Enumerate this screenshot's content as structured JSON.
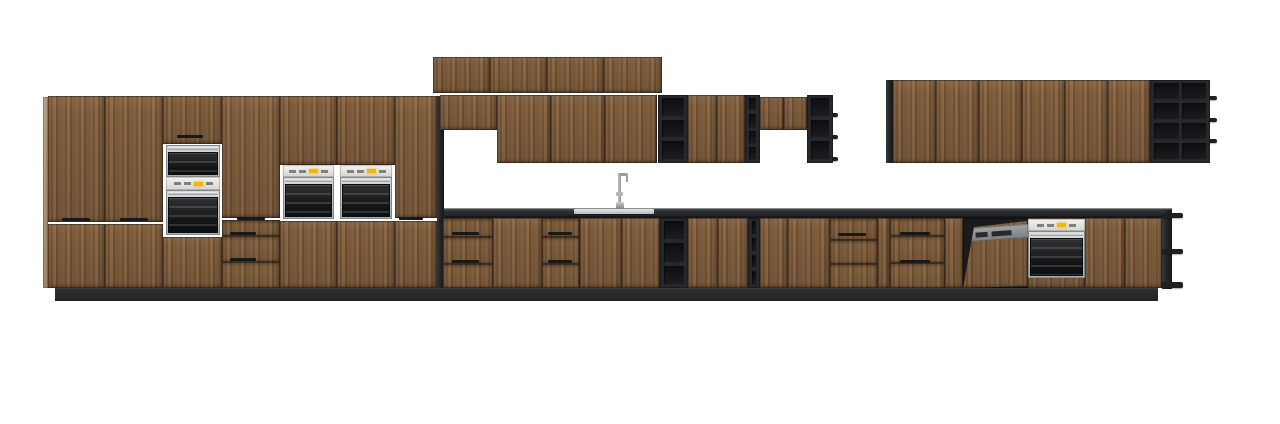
{
  "meta": {
    "canvas_w": 1280,
    "canvas_h": 424,
    "background": "#ffffff"
  },
  "palette": {
    "wood": "#7c5a3c",
    "wood_dark": "#6d4e33",
    "wood_light": "#8a6845",
    "frame_dark": "#26282b",
    "cubby_dark": "#101113",
    "counter": "#2c2f31",
    "plinth": "#26282a",
    "steel_light": "#dadddf",
    "steel": "#a9adb0",
    "panel_light": "#f3f2ef",
    "led_yellow": "#f2b705",
    "dishwasher_gray": "#8d9194",
    "oven_black": "#131416"
  },
  "scene": {
    "description_units": "kitchen-elevation-render",
    "units": [
      {
        "n": "plinth",
        "t": "plinth",
        "x": 55,
        "y": 288,
        "w": 1103,
        "h": 13
      },
      {
        "n": "countertop",
        "t": "counter",
        "x": 441,
        "y": 208,
        "w": 731,
        "h": 10
      },
      {
        "n": "sink-basin",
        "t": "sink",
        "x": 574,
        "y": 209,
        "w": 80,
        "h": 5
      },
      {
        "n": "tall-end-panel-left",
        "t": "door-lite",
        "x": 43,
        "y": 97,
        "w": 5,
        "h": 191
      },
      {
        "n": "tall-door-upper",
        "t": "door",
        "x": 48,
        "y": 96,
        "w": 57,
        "h": 126
      },
      {
        "n": "tall-door-lower",
        "t": "door",
        "x": 48,
        "y": 224,
        "w": 57,
        "h": 64
      },
      {
        "n": "door-handle",
        "t": "handle",
        "x": 62,
        "y": 218,
        "w": 28,
        "h": 3
      },
      {
        "n": "tall-door-upper",
        "t": "door",
        "x": 105,
        "y": 96,
        "w": 58,
        "h": 126
      },
      {
        "n": "tall-door-lower",
        "t": "door",
        "x": 105,
        "y": 224,
        "w": 58,
        "h": 64
      },
      {
        "n": "door-handle",
        "t": "handle",
        "x": 120,
        "y": 218,
        "w": 28,
        "h": 3
      },
      {
        "n": "appliance-tower-top-door",
        "t": "door",
        "x": 163,
        "y": 96,
        "w": 59,
        "h": 48
      },
      {
        "n": "door-handle",
        "t": "handle",
        "x": 177,
        "y": 135,
        "w": 26,
        "h": 3
      },
      {
        "n": "compact-oven",
        "t": "oven",
        "x": 166,
        "y": 145,
        "w": 54,
        "h": 32
      },
      {
        "n": "oven-control-panel",
        "t": "cpanel",
        "x": 166,
        "y": 177,
        "w": 54,
        "h": 13
      },
      {
        "n": "built-in-oven",
        "t": "oven",
        "x": 166,
        "y": 190,
        "w": 54,
        "h": 45
      },
      {
        "n": "appliance-tower-bottom-door",
        "t": "door",
        "x": 163,
        "y": 237,
        "w": 59,
        "h": 51
      },
      {
        "n": "tall-door-upper",
        "t": "door",
        "x": 222,
        "y": 96,
        "w": 58,
        "h": 122
      },
      {
        "n": "door-handle",
        "t": "handle",
        "x": 237,
        "y": 217,
        "w": 28,
        "h": 3
      },
      {
        "n": "tall-drawer",
        "t": "drawer",
        "x": 222,
        "y": 220,
        "w": 58,
        "h": 16
      },
      {
        "n": "tall-drawer",
        "t": "drawer",
        "x": 222,
        "y": 236,
        "w": 58,
        "h": 26
      },
      {
        "n": "drawer-handle",
        "t": "handle",
        "x": 230,
        "y": 232,
        "w": 26,
        "h": 3
      },
      {
        "n": "tall-drawer",
        "t": "drawer",
        "x": 222,
        "y": 262,
        "w": 58,
        "h": 26
      },
      {
        "n": "drawer-handle",
        "t": "handle",
        "x": 230,
        "y": 258,
        "w": 26,
        "h": 3
      },
      {
        "n": "appliance-tower-top-door",
        "t": "door",
        "x": 280,
        "y": 96,
        "w": 57,
        "h": 69
      },
      {
        "n": "oven-control-panel",
        "t": "cpanel",
        "x": 283,
        "y": 165,
        "w": 51,
        "h": 12
      },
      {
        "n": "built-in-oven",
        "t": "oven",
        "x": 283,
        "y": 177,
        "w": 51,
        "h": 42
      },
      {
        "n": "appliance-tower-bottom-door",
        "t": "door",
        "x": 280,
        "y": 221,
        "w": 57,
        "h": 67
      },
      {
        "n": "appliance-tower-top-door",
        "t": "door",
        "x": 337,
        "y": 96,
        "w": 58,
        "h": 69
      },
      {
        "n": "oven-control-panel",
        "t": "cpanel",
        "x": 340,
        "y": 165,
        "w": 52,
        "h": 12
      },
      {
        "n": "built-in-oven",
        "t": "oven",
        "x": 340,
        "y": 177,
        "w": 52,
        "h": 42
      },
      {
        "n": "appliance-tower-bottom-door",
        "t": "door",
        "x": 337,
        "y": 221,
        "w": 58,
        "h": 67
      },
      {
        "n": "tall-door-upper",
        "t": "door",
        "x": 395,
        "y": 96,
        "w": 42,
        "h": 122
      },
      {
        "n": "door-handle",
        "t": "handle",
        "x": 399,
        "y": 217,
        "w": 24,
        "h": 3
      },
      {
        "n": "tall-door-lower",
        "t": "door",
        "x": 395,
        "y": 221,
        "w": 42,
        "h": 67
      },
      {
        "n": "tall-run-side-panel",
        "t": "panel-dark",
        "x": 437,
        "y": 96,
        "w": 7,
        "h": 192
      },
      {
        "n": "wall-top-door",
        "t": "door",
        "x": 433,
        "y": 57,
        "w": 57,
        "h": 36
      },
      {
        "n": "wall-top-door",
        "t": "door",
        "x": 490,
        "y": 57,
        "w": 57,
        "h": 36
      },
      {
        "n": "wall-top-door",
        "t": "door",
        "x": 547,
        "y": 57,
        "w": 57,
        "h": 36
      },
      {
        "n": "wall-top-door",
        "t": "door",
        "x": 604,
        "y": 57,
        "w": 58,
        "h": 36
      },
      {
        "n": "wall-cabinet-short",
        "t": "door",
        "x": 440,
        "y": 95,
        "w": 57,
        "h": 35
      },
      {
        "n": "wall-door",
        "t": "door",
        "x": 497,
        "y": 95,
        "w": 54,
        "h": 68
      },
      {
        "n": "wall-door",
        "t": "door",
        "x": 551,
        "y": 95,
        "w": 54,
        "h": 68
      },
      {
        "n": "wall-door",
        "t": "door",
        "x": 605,
        "y": 95,
        "w": 52,
        "h": 68
      },
      {
        "n": "wall-open-shelf",
        "t": "shelf",
        "x": 658,
        "y": 95,
        "w": 30,
        "h": 68,
        "r": 3
      },
      {
        "n": "wall-door",
        "t": "door",
        "x": 688,
        "y": 95,
        "w": 29,
        "h": 68
      },
      {
        "n": "wall-door",
        "t": "door",
        "x": 717,
        "y": 95,
        "w": 28,
        "h": 68
      },
      {
        "n": "wall-wine-shelf",
        "t": "shelf",
        "x": 745,
        "y": 95,
        "w": 15,
        "h": 68,
        "r": 4
      },
      {
        "n": "wall-short-door",
        "t": "door",
        "x": 760,
        "y": 97,
        "w": 24,
        "h": 33
      },
      {
        "n": "wall-short-door",
        "t": "door",
        "x": 784,
        "y": 97,
        "w": 23,
        "h": 33
      },
      {
        "n": "wall-open-shelf",
        "t": "shelf",
        "x": 807,
        "y": 95,
        "w": 26,
        "h": 68,
        "r": 3
      },
      {
        "n": "shelf-fin",
        "t": "fin",
        "x": 833,
        "y": 113,
        "w": 5,
        "h": 4
      },
      {
        "n": "shelf-fin",
        "t": "fin",
        "x": 833,
        "y": 135,
        "w": 5,
        "h": 4
      },
      {
        "n": "shelf-fin",
        "t": "fin",
        "x": 833,
        "y": 157,
        "w": 5,
        "h": 4
      },
      {
        "n": "wall-run-edge-panel",
        "t": "panel-dark",
        "x": 886,
        "y": 80,
        "w": 7,
        "h": 83
      },
      {
        "n": "wall-door",
        "t": "door",
        "x": 893,
        "y": 80,
        "w": 43,
        "h": 83
      },
      {
        "n": "wall-door",
        "t": "door",
        "x": 936,
        "y": 80,
        "w": 43,
        "h": 83
      },
      {
        "n": "wall-door",
        "t": "door",
        "x": 979,
        "y": 80,
        "w": 43,
        "h": 83
      },
      {
        "n": "wall-door",
        "t": "door",
        "x": 1022,
        "y": 80,
        "w": 43,
        "h": 83
      },
      {
        "n": "wall-door",
        "t": "door",
        "x": 1065,
        "y": 80,
        "w": 43,
        "h": 83
      },
      {
        "n": "wall-door",
        "t": "door",
        "x": 1108,
        "y": 80,
        "w": 42,
        "h": 83
      },
      {
        "n": "wall-open-shelf-grid",
        "t": "grid",
        "x": 1150,
        "y": 80,
        "w": 60,
        "h": 83,
        "r": 4,
        "c": 2
      },
      {
        "n": "shelf-fin",
        "t": "fin",
        "x": 1210,
        "y": 96,
        "w": 7,
        "h": 4
      },
      {
        "n": "shelf-fin",
        "t": "fin",
        "x": 1210,
        "y": 118,
        "w": 7,
        "h": 4
      },
      {
        "n": "shelf-fin",
        "t": "fin",
        "x": 1210,
        "y": 139,
        "w": 7,
        "h": 4
      },
      {
        "n": "faucet",
        "t": "faucet",
        "x": 612,
        "y": 172,
        "w": 17,
        "h": 37
      },
      {
        "n": "base-drawer",
        "t": "drawer",
        "x": 443,
        "y": 218,
        "w": 50,
        "h": 19
      },
      {
        "n": "base-drawer",
        "t": "drawer",
        "x": 443,
        "y": 237,
        "w": 50,
        "h": 27
      },
      {
        "n": "drawer-handle",
        "t": "handle",
        "x": 452,
        "y": 232,
        "w": 27,
        "h": 3
      },
      {
        "n": "base-drawer",
        "t": "drawer",
        "x": 443,
        "y": 264,
        "w": 50,
        "h": 24
      },
      {
        "n": "drawer-handle",
        "t": "handle",
        "x": 452,
        "y": 260,
        "w": 27,
        "h": 3
      },
      {
        "n": "base-door",
        "t": "door",
        "x": 493,
        "y": 218,
        "w": 49,
        "h": 70
      },
      {
        "n": "base-drawer",
        "t": "drawer",
        "x": 542,
        "y": 218,
        "w": 38,
        "h": 19
      },
      {
        "n": "base-drawer",
        "t": "drawer",
        "x": 542,
        "y": 237,
        "w": 38,
        "h": 27
      },
      {
        "n": "drawer-handle",
        "t": "handle",
        "x": 548,
        "y": 232,
        "w": 24,
        "h": 3
      },
      {
        "n": "base-drawer",
        "t": "drawer",
        "x": 542,
        "y": 264,
        "w": 38,
        "h": 24
      },
      {
        "n": "drawer-handle",
        "t": "handle",
        "x": 548,
        "y": 260,
        "w": 24,
        "h": 3
      },
      {
        "n": "base-door",
        "t": "door",
        "x": 580,
        "y": 218,
        "w": 42,
        "h": 70
      },
      {
        "n": "sink-base-door",
        "t": "door",
        "x": 622,
        "y": 218,
        "w": 38,
        "h": 70
      },
      {
        "n": "base-open-shelf",
        "t": "shelf",
        "x": 660,
        "y": 218,
        "w": 28,
        "h": 70,
        "r": 3
      },
      {
        "n": "base-door",
        "t": "door",
        "x": 688,
        "y": 218,
        "w": 30,
        "h": 70
      },
      {
        "n": "base-door",
        "t": "door",
        "x": 718,
        "y": 218,
        "w": 30,
        "h": 70
      },
      {
        "n": "base-wine-shelf",
        "t": "shelf",
        "x": 748,
        "y": 218,
        "w": 12,
        "h": 70,
        "r": 4
      },
      {
        "n": "base-door",
        "t": "door",
        "x": 760,
        "y": 218,
        "w": 28,
        "h": 70
      },
      {
        "n": "base-door",
        "t": "door",
        "x": 788,
        "y": 218,
        "w": 42,
        "h": 70
      },
      {
        "n": "base-drawer",
        "t": "drawer",
        "x": 830,
        "y": 218,
        "w": 48,
        "h": 22
      },
      {
        "n": "drawer-handle",
        "t": "handle",
        "x": 838,
        "y": 233,
        "w": 28,
        "h": 3
      },
      {
        "n": "base-drawer",
        "t": "drawer",
        "x": 830,
        "y": 240,
        "w": 48,
        "h": 24
      },
      {
        "n": "base-drawer",
        "t": "drawer",
        "x": 830,
        "y": 264,
        "w": 48,
        "h": 24
      },
      {
        "n": "base-filler-door",
        "t": "door",
        "x": 878,
        "y": 218,
        "w": 12,
        "h": 70
      },
      {
        "n": "base-drawer",
        "t": "drawer",
        "x": 890,
        "y": 218,
        "w": 55,
        "h": 18
      },
      {
        "n": "base-drawer",
        "t": "drawer",
        "x": 890,
        "y": 236,
        "w": 55,
        "h": 27
      },
      {
        "n": "drawer-handle",
        "t": "handle",
        "x": 900,
        "y": 232,
        "w": 30,
        "h": 3
      },
      {
        "n": "base-drawer",
        "t": "drawer",
        "x": 890,
        "y": 263,
        "w": 55,
        "h": 25
      },
      {
        "n": "drawer-handle",
        "t": "handle",
        "x": 900,
        "y": 260,
        "w": 30,
        "h": 3
      },
      {
        "n": "base-door",
        "t": "door",
        "x": 945,
        "y": 218,
        "w": 18,
        "h": 70
      },
      {
        "n": "dishwasher-open",
        "t": "dw",
        "x": 963,
        "y": 218,
        "w": 65,
        "h": 70
      },
      {
        "n": "base-door",
        "t": "door",
        "x": 1028,
        "y": 218,
        "w": 57,
        "h": 70
      },
      {
        "n": "oven-control-panel",
        "t": "cpanel",
        "x": 1028,
        "y": 219,
        "w": 57,
        "h": 12
      },
      {
        "n": "built-in-oven",
        "t": "oven",
        "x": 1028,
        "y": 231,
        "w": 57,
        "h": 47
      },
      {
        "n": "base-door",
        "t": "door",
        "x": 1085,
        "y": 218,
        "w": 40,
        "h": 70
      },
      {
        "n": "base-door",
        "t": "door",
        "x": 1125,
        "y": 218,
        "w": 37,
        "h": 70
      },
      {
        "n": "end-shelf-panel",
        "t": "panel-dark",
        "x": 1162,
        "y": 210,
        "w": 10,
        "h": 79
      },
      {
        "n": "shelf-fin",
        "t": "fin",
        "x": 1162,
        "y": 213,
        "w": 21,
        "h": 5
      },
      {
        "n": "shelf-fin",
        "t": "fin",
        "x": 1162,
        "y": 249,
        "w": 21,
        "h": 5
      },
      {
        "n": "shelf-fin",
        "t": "fin",
        "x": 1162,
        "y": 282,
        "w": 21,
        "h": 6
      }
    ]
  }
}
